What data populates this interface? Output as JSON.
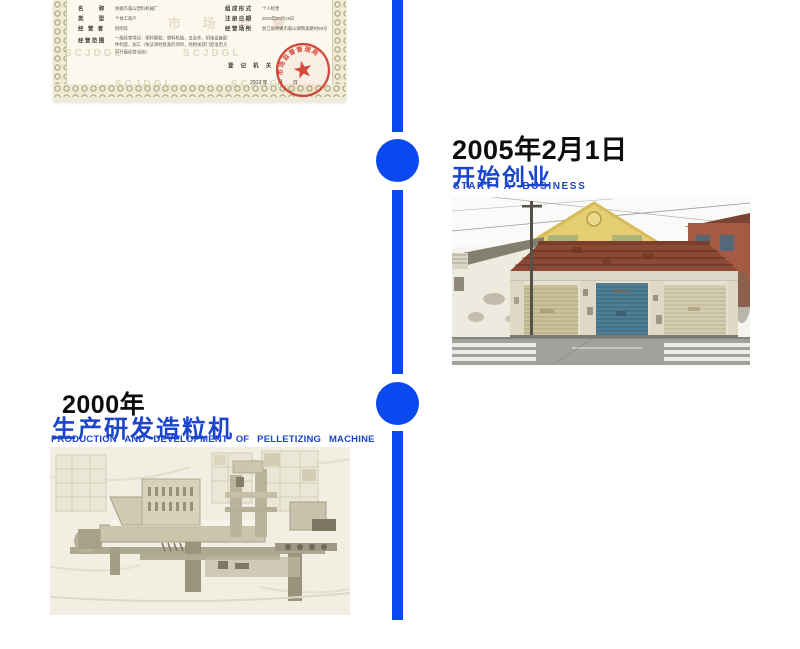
{
  "colors": {
    "timeline_blue": "#0b49f0",
    "heading_blue": "#1b45cd",
    "date_black": "#0d0d0d",
    "cert_paper": "#f8f4e6",
    "cert_border_olive": "#a8a57a",
    "stamp_red": "#d0392b"
  },
  "timeline": {
    "entries": [
      {
        "date": "2005年2月1日",
        "title_zh": "开始创业",
        "title_en": "START A BUSINESS",
        "photo": "old-workshop-building-with-roller-doors"
      },
      {
        "date": "2000年",
        "title_zh": "生产研发造粒机",
        "title_en": "PRODUCTION AND DEVELOPMENT OF PELLETIZING MACHINE",
        "photo": "faded-pelletizing-machine-workshop"
      }
    ]
  },
  "certificate": {
    "rows_left": [
      {
        "label": "名　　称",
        "value": "余姚市临山塑料机械厂"
      },
      {
        "label": "类　　型",
        "value": "个体工商户"
      },
      {
        "label": "经 营 者",
        "value": "倪明华"
      },
      {
        "label": "经营范围",
        "value": "一般经营项目：塑料颗粒、塑料机械、五金件、机电设备配件制造、加工（依法须经批准的项目，经相关部门批准后方可开展经营活动）"
      }
    ],
    "rows_right": [
      {
        "label": "组成形式",
        "value": "个人经营"
      },
      {
        "label": "注册日期",
        "value": "2019年06月19日"
      },
      {
        "label": "经营场所",
        "value": "浙江省余姚市临山镇陶家路村88号"
      }
    ],
    "registrar_label": "登 记 机 关",
    "issue_date_line": "2019 年　　月　　日",
    "watermark_small": "SCJDGL",
    "watermark_large": "市 场 监 督",
    "seal_text": "市场监督管理局"
  }
}
